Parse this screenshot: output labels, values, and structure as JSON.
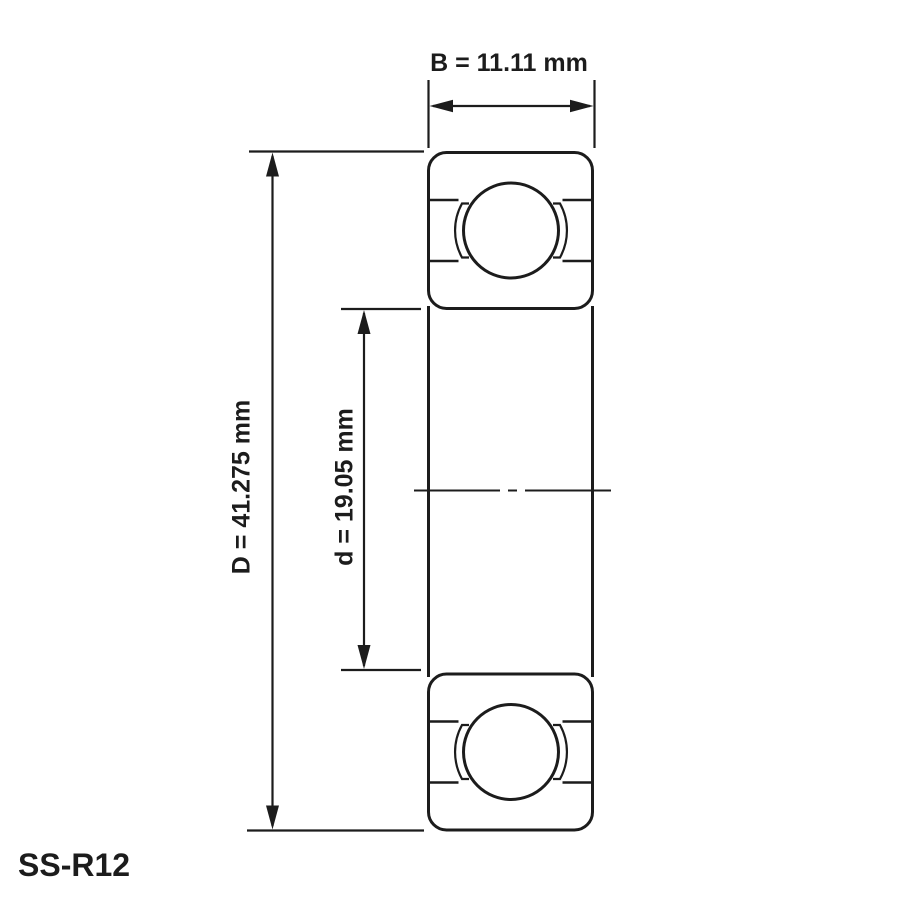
{
  "drawing": {
    "title": "bearing-dimension-drawing",
    "part_label": "SS-R12",
    "dimensions": {
      "B": {
        "symbol": "B",
        "value": "11.11",
        "unit": "mm",
        "label": "B = 11.11 mm"
      },
      "D": {
        "symbol": "D",
        "value": "41.275",
        "unit": "mm",
        "label": "D = 41.275 mm"
      },
      "d": {
        "symbol": "d",
        "value": "19.05",
        "unit": "mm",
        "label": "d = 19.05 mm"
      }
    },
    "colors": {
      "line": "#1c1c1c",
      "ring_fill": "#e6e6e6",
      "background": "#ffffff"
    }
  }
}
